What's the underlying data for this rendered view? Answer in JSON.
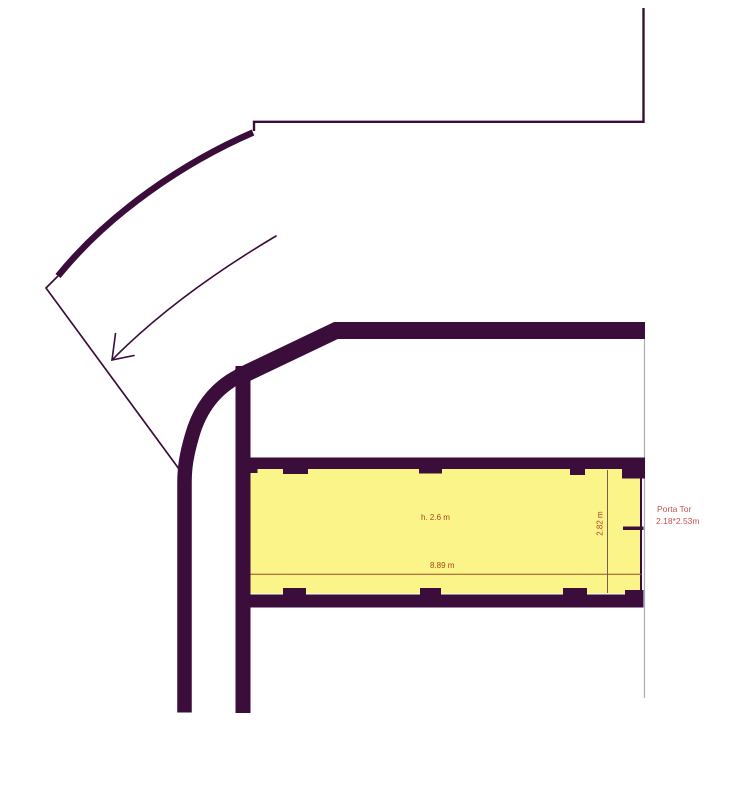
{
  "document": {
    "type": "architectural floor plan",
    "background": "#ffffff"
  },
  "colors": {
    "wall": "#3a0d3b",
    "room_fill": "#fbf489",
    "dim_line": "#9a4f2b",
    "dim_line_vertical": "#7d5a52",
    "dim_text": "#a8441c",
    "door_text": "#c4524e",
    "boundary_line": "#adaab5"
  },
  "labels": {
    "room_height": "h. 2.6 m",
    "room_width": "8.89 m",
    "room_depth": "2.82 m",
    "door_title": "Porta Tor",
    "door_dimensions": "2.18*2.53m"
  }
}
